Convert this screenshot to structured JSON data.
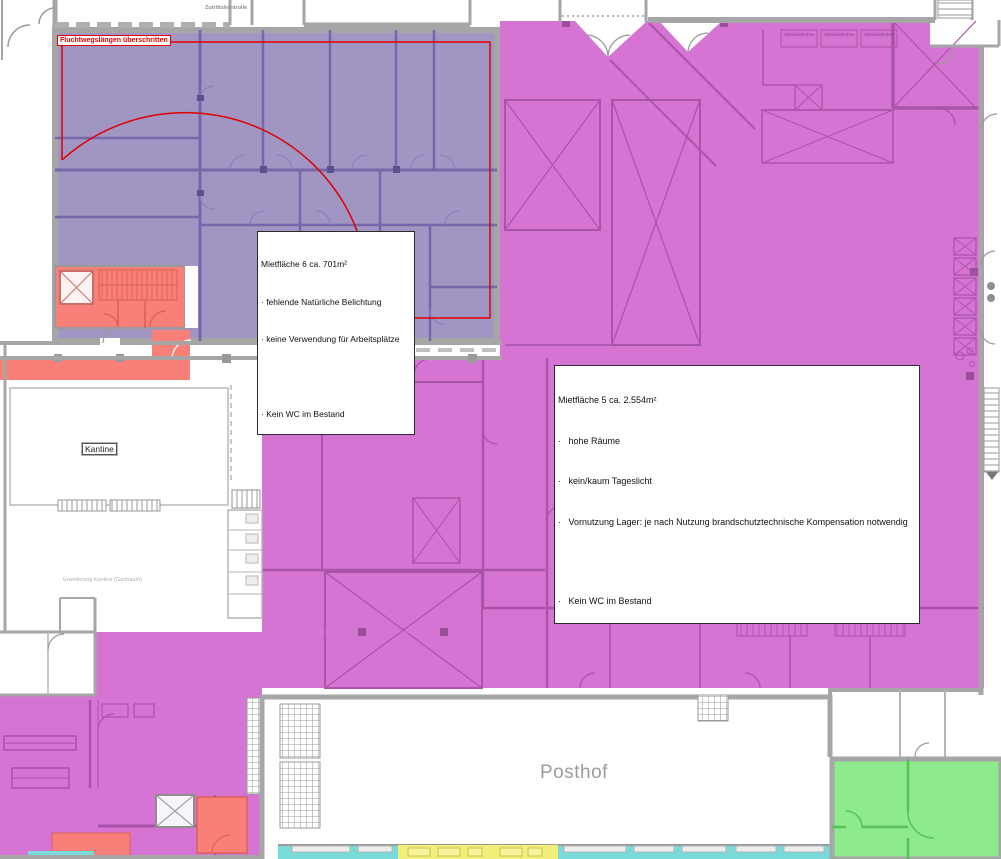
{
  "labels": {
    "fluchtweg": "Fluchtwegslängen überschritten",
    "zutrittskontrolle": "Zutrittskontrolle",
    "kantine": "Kantine",
    "erweiterung_kantine": "Erweiterung Kantine (Gastraum)",
    "posthof": "Posthof",
    "oberladebuehne": "Oberladebühne"
  },
  "annotations": {
    "m6": {
      "title": "Mietfläche 6 ca. 701m²",
      "items": [
        "· fehlende Natürliche Belichtung",
        "· keine Verwendung für Arbeitsplätze",
        "",
        "· Kein WC im Bestand"
      ]
    },
    "m5": {
      "title": "Mietfläche 5 ca. 2.554m²",
      "items": [
        "·   hohe Räume",
        "·   kein/kaum Tageslicht",
        "·   Vornutzung Lager: je nach Nutzung brandschutztechnische Kompensation notwendig",
        "",
        "·   Kein WC im Bestand"
      ]
    }
  },
  "colors": {
    "zone_mietflaeche_6": "#a195c4",
    "zone_mietflaeche_6_walls": "#7668a8",
    "zone_mietflaeche_5": "#d674d4",
    "zone_mietflaeche_5_walls": "#a953a9",
    "alert_red": "#f98078",
    "alert_red_lines": "#d95f57",
    "green_area": "#8deb8d",
    "green_walls": "#58c158",
    "cyan_strip": "#79dada",
    "yellow_strip": "#f2ee79",
    "escape_route_line": "#e10000",
    "walls_gray": "#a6a6a6"
  }
}
